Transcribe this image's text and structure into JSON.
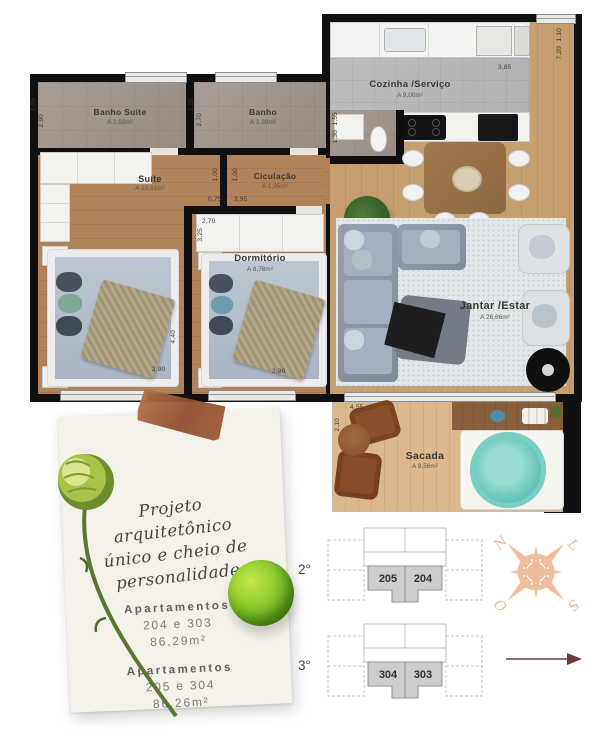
{
  "plan": {
    "rooms": {
      "banho_suite": {
        "name": "Banho Suite",
        "area": "A 3,63m²"
      },
      "banho": {
        "name": "Banho",
        "area": "A 3,38m²"
      },
      "suite": {
        "name": "Suíte",
        "area": "A 13,51m²"
      },
      "circulacao": {
        "name": "Ciculação",
        "area": "A 1,95m²"
      },
      "dormitorio": {
        "name": "Dormitório",
        "area": "A 8,78m²"
      },
      "cozinha": {
        "name": "Cozinha /Serviço",
        "area": "A 9,00m²"
      },
      "jantar": {
        "name": "Jantar /Estar",
        "area": "A 26,66m²"
      },
      "sacada": {
        "name": "Sacada",
        "area": "A 9,56m²"
      }
    },
    "dims": {
      "bs_w": "1,25",
      "bs_h": "2,90",
      "b_w": "1,25",
      "b_h": "2,70",
      "c_v1": "1,00",
      "c_v2": "1,00",
      "c_h1": "0,75",
      "c_h2": "3,95",
      "dc_w": "2,70",
      "dc_h": "3,25",
      "su_d": "4,40",
      "su_w": "2,90",
      "do_w": "2,90",
      "k_v1": "1,55",
      "k_v2": "1,30",
      "k_w": "3,85",
      "r_v1": "1,10",
      "r_v2": "7,20",
      "sa_w": "4,55",
      "sa_h": "2,10"
    }
  },
  "note": {
    "line1": "Projeto",
    "line2": "arquitetônico",
    "line3": "único e cheio de",
    "line4": "personalidade",
    "apts": [
      {
        "title": "Apartamentos",
        "units": "204 e 303",
        "area": "86,29m²"
      },
      {
        "title": "Apartamentos",
        "units": "205 e 304",
        "area": "86,26m²"
      }
    ]
  },
  "floors": [
    {
      "label": "2°",
      "left_unit": "205",
      "right_unit": "204"
    },
    {
      "label": "3°",
      "left_unit": "304",
      "right_unit": "303"
    }
  ],
  "compass": {
    "n": "N",
    "l": "L",
    "s": "S",
    "o": "O"
  },
  "colors": {
    "wall": "#101010",
    "tape_copper": "#a7603a",
    "compass_salmon": "#eebd9c",
    "arrow_maroon": "#6e3a3c",
    "hot_tub_teal": "#63c3b8",
    "unit_highlight": "#cdcdcd"
  }
}
